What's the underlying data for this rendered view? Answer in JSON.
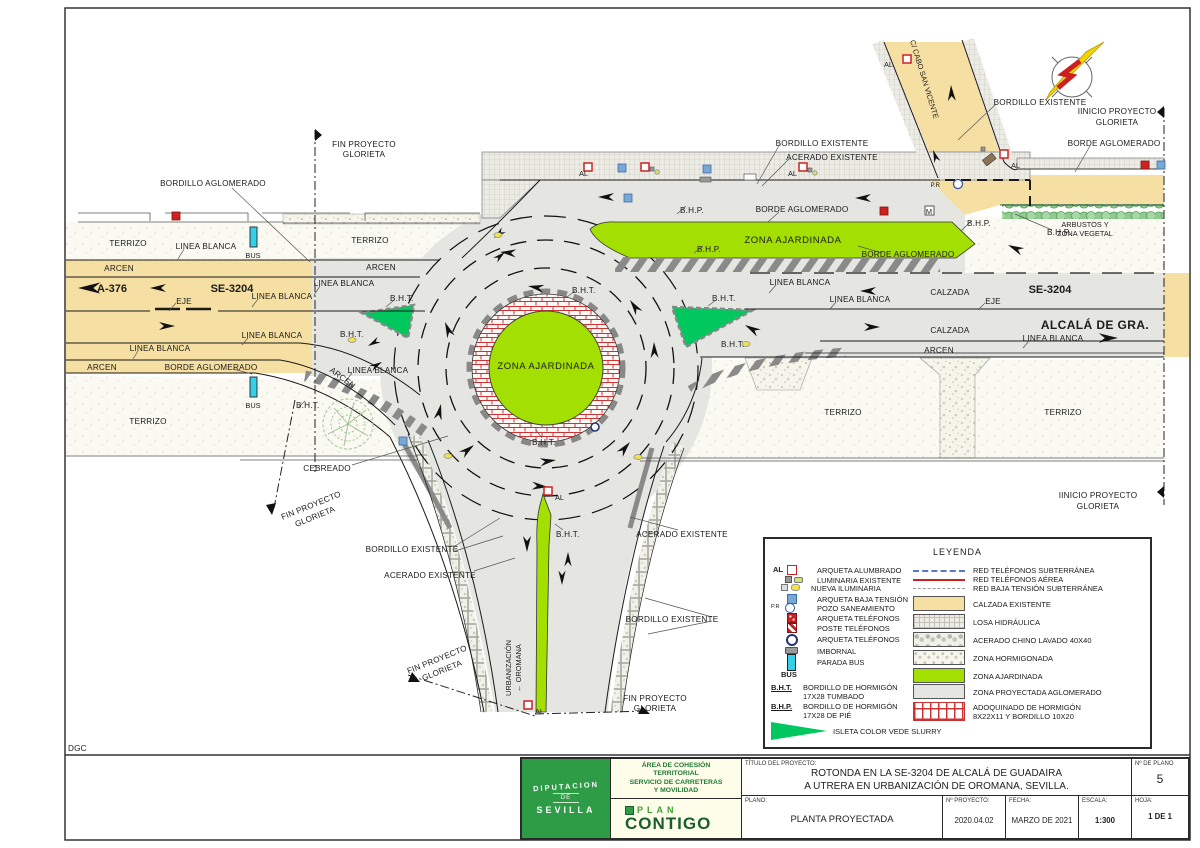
{
  "drawing": {
    "labels": {
      "bordillo_aglomerado": "BORDILLO AGLOMERADO",
      "borde_aglomerado": "BORDE AGLOMERADO",
      "bordillo_existente": "BORDILLO EXISTENTE",
      "acerado_existente": "ACERADO EXISTENTE",
      "terrizo": "TERRIZO",
      "linea_blanca": "LINEA BLANCA",
      "arcen": "ARCEN",
      "eje": "EJE",
      "bus": "BUS",
      "al": "AL",
      "pr": "P.R",
      "bht": "B.H.T.",
      "bhp": "B.H.P.",
      "zona_ajardinada": "ZONA AJARDINADA",
      "calzada": "CALZADA",
      "cebreado": "CEBREADO",
      "arbustos_1": "ARBUSTOS Y",
      "arbustos_2": "ZONA VEGETAL",
      "fin_proyecto_1": "FIN PROYECTO",
      "fin_proyecto_2": "GLORIETA",
      "inicio_proyecto_1": "IINICIO PROYECTO",
      "inicio_proyecto_2": "GLORIETA",
      "dgc": "DGC",
      "m": "M"
    },
    "roads": {
      "a376": "A-376",
      "se3204": "SE-3204",
      "alcala": "ALCALÁ DE GRA.",
      "cabo_san_vicente": "C/ CABO SAN VICENTE",
      "urbanizacion": "URBANIZACIÓN",
      "oromana": "← OROMANA"
    }
  },
  "legend": {
    "title": "LEYENDA",
    "al": "AL",
    "pr": "P.R",
    "bus": "BUS",
    "items_left": [
      "ARQUETA ALUMBRADO",
      "LUMINARIA EXISTENTE",
      "NUEVA ILUMINARIA",
      "ARQUETA BAJA TENSIÓN",
      "POZO SANEAMIENTO",
      "ARQUETA TELÉFONOS",
      "POSTE TELÉFONOS",
      "ARQUETA TELÉFONOS",
      "IMBORNAL",
      "PARADA BUS"
    ],
    "bht_term": "B.H.T.",
    "bht_line1": "BORDILLO DE HORMIGÓN",
    "bht_line2": "17X28 TUMBADO",
    "bhp_term": "B.H.P.",
    "bhp_line1": "BORDILLO DE HORMIGÓN",
    "bhp_line2": "17X28 DE PIÉ",
    "isleta": "ISLETA COLOR VEDE SLURRY",
    "lines": [
      "RED TELÉFONOS SUBTERRÁNEA",
      "RED TELÉFONOS AÉREA",
      "RED BAJA TENSIÓN SUBTERRÁNEA"
    ],
    "areas": [
      "CALZADA  EXISTENTE",
      "LOSA  HIDRÁULICA",
      "ACERADO CHINO LAVADO 40X40",
      "ZONA HORMIGONADA",
      "ZONA AJARDINADA",
      "ZONA PROYECTADA AGLOMERADO"
    ],
    "adoquinado_1": "ADOQUINADO DE HORMIGÓN",
    "adoquinado_2": "8X22X11 Y BORDILLO 10X20"
  },
  "titleblock": {
    "org_name_1": "DIPUTACION",
    "org_name_2": "DE",
    "org_name_3": "SEVILLA",
    "area_1": "ÁREA DE COHESIÓN",
    "area_2": "TERRITORIAL",
    "area_3": "SERVICIO DE CARRETERAS",
    "area_4": "Y MOVILIDAD",
    "plan": "PLAN",
    "contigo": "CONTIGO",
    "titulo_label": "TÍTULO DEL PROYECTO:",
    "titulo_1": "ROTONDA EN LA SE-3204 DE ALCALÁ DE GUADAIRA",
    "titulo_2": "A UTRERA EN URBANIZACIÓN DE OROMANA, SEVILLA.",
    "num_plano_label": "Nº DE PLANO",
    "num_plano": "5",
    "plano_label": "PLANO:",
    "plano": "PLANTA PROYECTADA",
    "num_proyecto_label": "Nº PROYECTO:",
    "num_proyecto": "2020.04.02",
    "fecha_label": "FECHA:",
    "fecha": "MARZO DE 2021",
    "escala_label": "ESCALA:",
    "hoja_label": "HOJA:",
    "escala": "1:300",
    "hoja": "1 DE 1"
  },
  "colors": {
    "calzada_existente": "#F6DFA2",
    "zona_proyectada": "#E5E5E2",
    "zona_ajardinada": "#A3DF00",
    "isleta_verde": "#00C85F",
    "parada_bus": "#35D0E8",
    "rojo_arqueta": "#CC2222",
    "azul_arqueta": "#7BA7D7",
    "verde_institucional": "#2E9B47"
  }
}
